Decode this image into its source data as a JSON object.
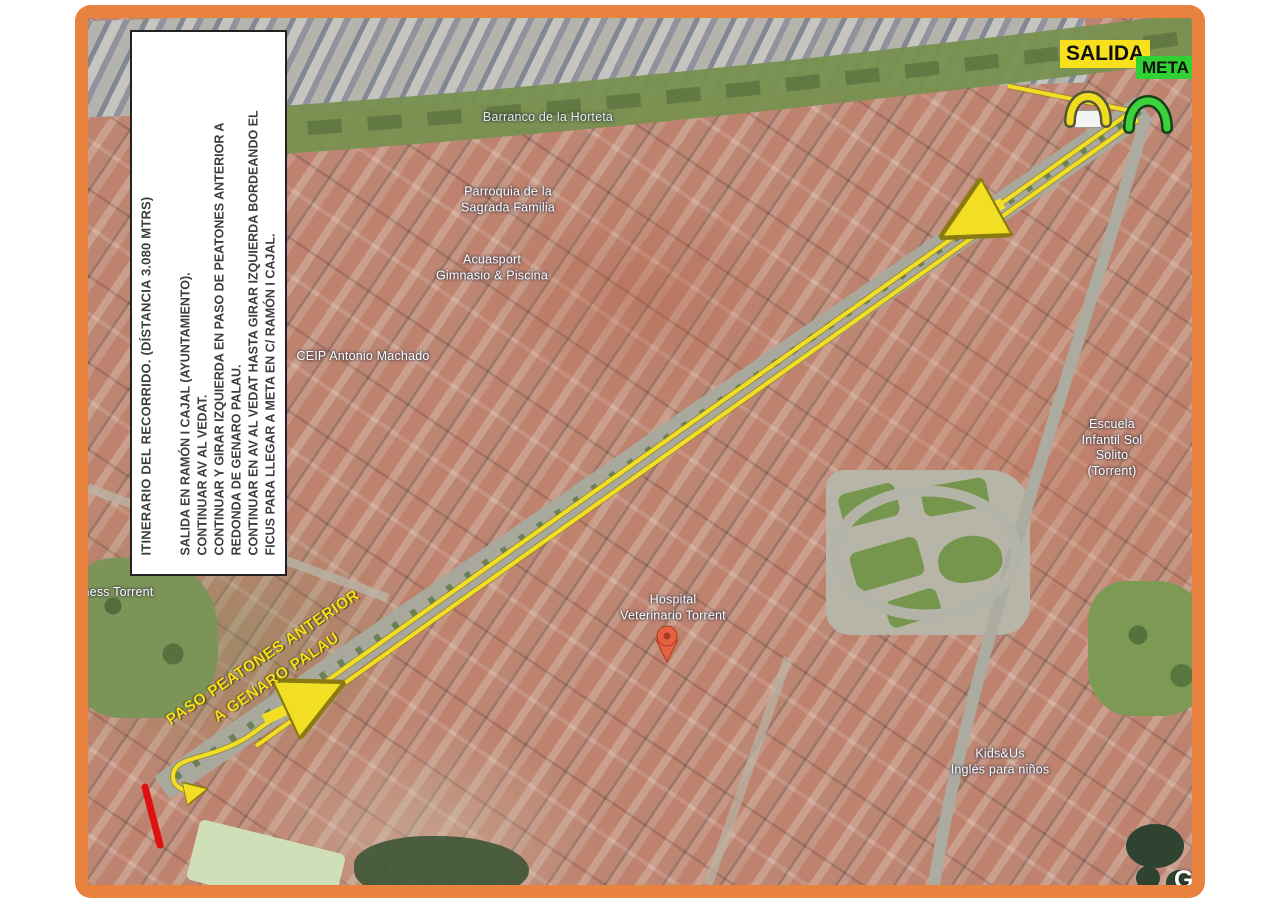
{
  "frame": {
    "border_color": "#e8823e"
  },
  "info_box": {
    "title": "ITINERARIO DEL RECORRIDO. (DÍSTANCIA 3.080 MTRS)",
    "lines": [
      "SALIDA EN  RAMÓN I CAJAL (AYUNTAMIENTO).",
      "CONTINUAR AV AL VEDAT.",
      "CONTINUAR Y GIRAR IZQUIERDA EN PASO DE PEATONES ANTERIOR A",
      "REDONDA DE GENARO PALAU.",
      "CONTINUAR EN AV AL VEDAT HASTA GIRAR IZQUIERDA BORDEANDO EL",
      "FICUS PARA LLEGAR A META EN C/ RAMÓN I CAJAL."
    ]
  },
  "route": {
    "start_label": "SALIDA",
    "finish_label": "META",
    "crossing_note": "PASO PEATONES ANTERIOR\nA GENARO PALAU",
    "route_color": "#f2de22",
    "start_badge_color": "#f8e11c",
    "finish_badge_color": "#2fd133",
    "closed_segment_color": "#e01010"
  },
  "map_labels": {
    "barranco": "Barranco de la Horteta",
    "parroquia": "Parroquia de la\nSagrada Familia",
    "acuasport": "Acuasport\nGimnasio & Piscina",
    "ceip": "CEIP Antonio Machado",
    "hospital": "Hospital\nVeterinario Torrent",
    "escuela": "Escuela Infantil Sol\nSolito (Torrent)",
    "kidsus": "Kids&Us\nInglés para niños",
    "fitness": "ness Torrent"
  },
  "watermark": "G"
}
